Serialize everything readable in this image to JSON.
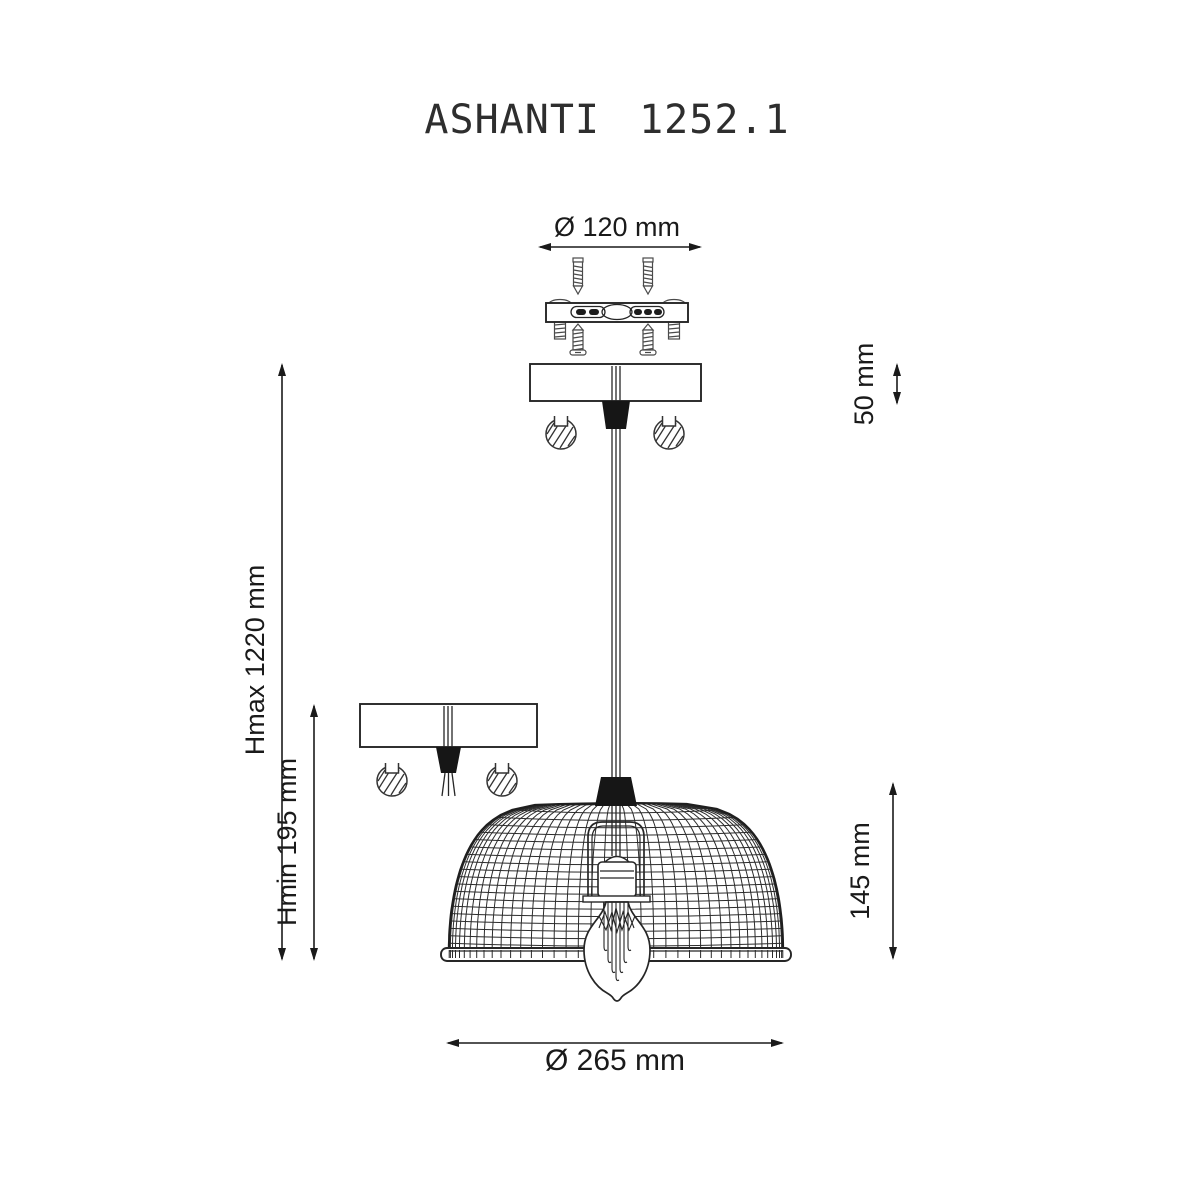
{
  "drawing": {
    "title": "ASHANTI 1252.1",
    "dimensions": {
      "mount_plate_diameter": "Ø 120 mm",
      "canopy_height": "50 mm",
      "max_height": "Hmax 1220 mm",
      "min_height": "Hmin 195 mm",
      "shade_height": "145 mm",
      "shade_diameter": "Ø 265 mm"
    },
    "colors": {
      "line": "#262626",
      "dimension": "#1a1a1a",
      "background": "#ffffff"
    }
  }
}
